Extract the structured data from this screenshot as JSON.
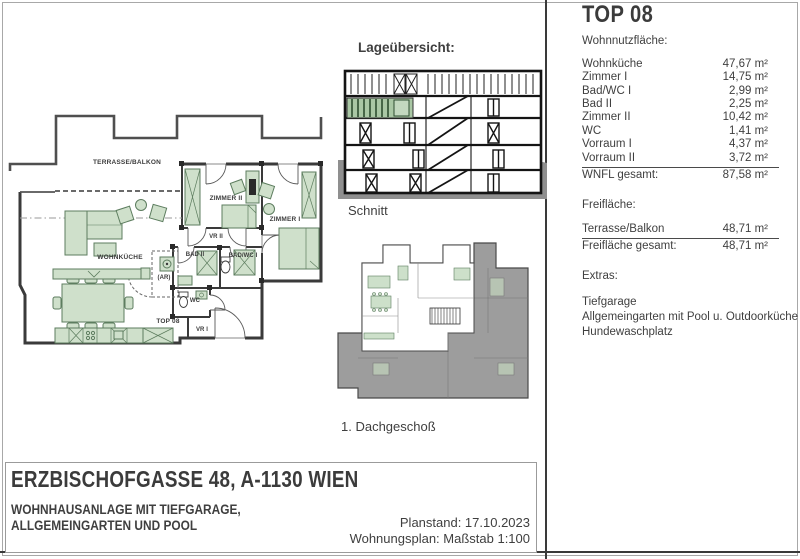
{
  "colors": {
    "furniture_green": "#cfe0cb",
    "furniture_stroke": "#5d7d5f",
    "section_highlight_green": "#a9c7a4",
    "wall_dark": "#3a3a3a",
    "neighbor_gray": "#9d9d9d",
    "ground_gray": "#8f8f8f",
    "text_gray": "#3f3f3f"
  },
  "right_panel": {
    "title": "TOP 08",
    "wnf_heading": "Wohnnutzfläche:",
    "rooms": [
      {
        "label": "Wohnküche",
        "value": "47,67 m²"
      },
      {
        "label": "Zimmer I",
        "value": "14,75 m²"
      },
      {
        "label": "Bad/WC I",
        "value": "2,99 m²"
      },
      {
        "label": "Bad II",
        "value": "2,25 m²"
      },
      {
        "label": "Zimmer II",
        "value": "10,42 m²"
      },
      {
        "label": "WC",
        "value": "1,41 m²"
      },
      {
        "label": "Vorraum I",
        "value": "4,37 m²"
      },
      {
        "label": "Vorraum II",
        "value": "3,72 m²"
      }
    ],
    "wnfl_total": {
      "label": "WNFL gesamt:",
      "value": "87,58 m²"
    },
    "frei_heading": "Freifläche:",
    "freiflaechen": [
      {
        "label": "Terrasse/Balkon",
        "value": "48,71 m²"
      }
    ],
    "frei_total": {
      "label": "Freifläche gesamt:",
      "value": "48,71 m²"
    },
    "extras_heading": "Extras:",
    "extras": [
      "Tiefgarage",
      "Allgemeingarten mit Pool u. Outdoorküche",
      "Hundewaschplatz"
    ]
  },
  "plan": {
    "unit": "TOP 08",
    "labels": {
      "terrasse": "TERRASSE/BALKON",
      "wohnkueche": "WOHNKÜCHE",
      "zimmer2": "ZIMMER II",
      "zimmer1": "ZIMMER I",
      "vr2": "VR II",
      "bad2": "BAD II",
      "badwc1": "BAD/WC I",
      "ar": "(AR)",
      "wc": "WC",
      "vr1": "VR I"
    }
  },
  "section_drawing": {
    "title": "Lageübersicht:",
    "caption": "Schnitt"
  },
  "keyplan": {
    "caption": "1. Dachgeschoß"
  },
  "title_block": {
    "address": "ERZBISCHOFGASSE 48, A-1130 WIEN",
    "subtitle_line1": "WOHNHAUSANLAGE MIT TIEFGARAGE,",
    "subtitle_line2": "ALLGEMEINGARTEN UND POOL",
    "planstand": "Planstand: 17.10.2023",
    "massstab": "Wohnungsplan: Maßstab 1:100"
  }
}
